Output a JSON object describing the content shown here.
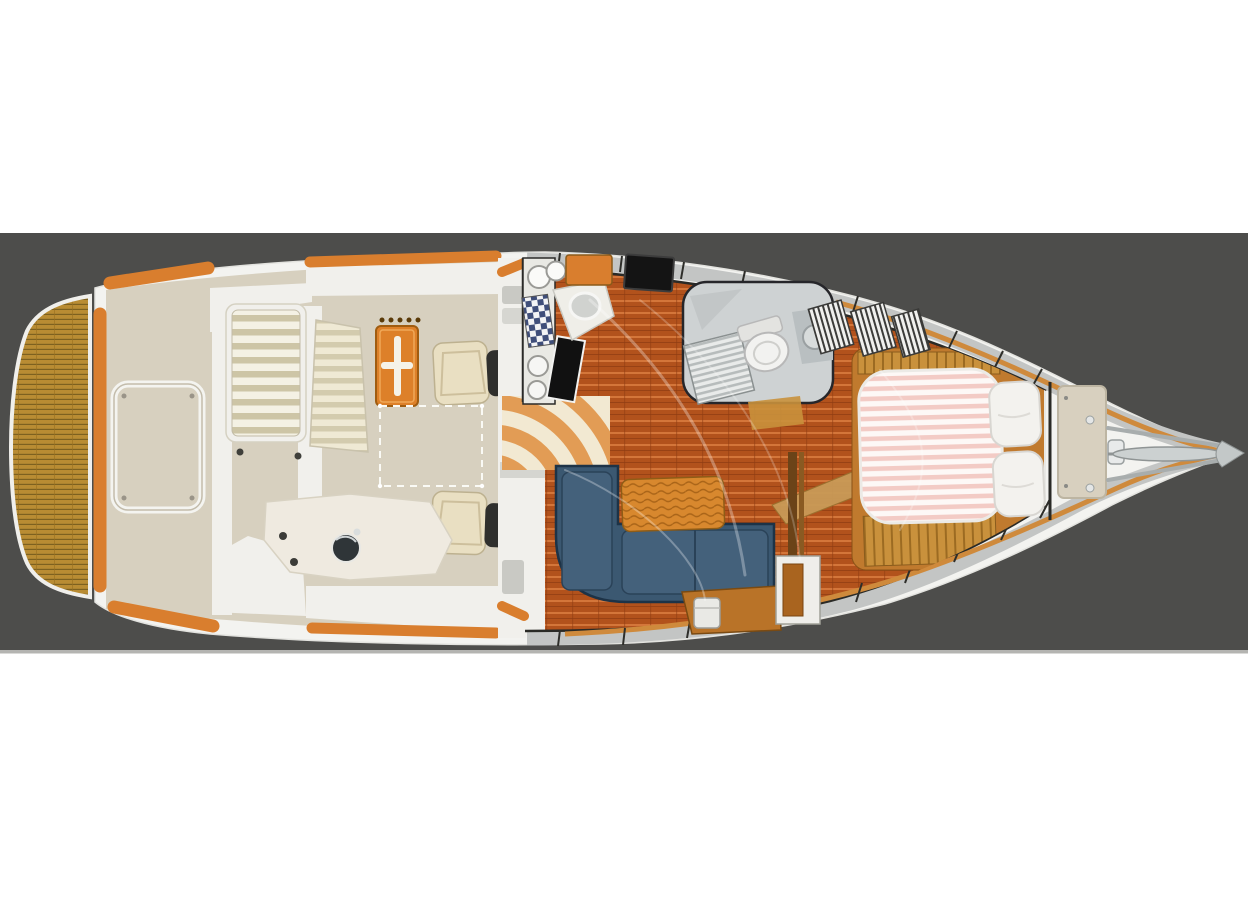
{
  "scene": {
    "type": "boat-deck-floor-plan",
    "description": "Top-down yacht interior floor plan, stern at left with teak swim platform, cockpit with table and helm chairs, salon with L-shaped blue settee, galley, head with shower and toilet, forward island berth with pillows, bow pulpit with anchor at right, drawn on a dark gray horizontal band over a white page",
    "parts": [
      "swim-platform",
      "transom",
      "cockpit-sole",
      "engine-hatch",
      "transom-bench",
      "flybridge-steps",
      "cockpit-table",
      "helm-chair-aft",
      "helm-chair-forward",
      "wet-bar-sink",
      "side-walkway",
      "companionway-stairs",
      "galley-sinks",
      "galley-stove",
      "galley-oven",
      "galley-cabinet",
      "tv-panel",
      "head-compartment",
      "shower-grate",
      "toilet",
      "head-sink",
      "salon-floor",
      "l-settee",
      "bolster-cushion",
      "salon-cabinet",
      "handrail-post",
      "starboard-cabinet",
      "v-berth-mattress",
      "berth-pillows",
      "berth-steps",
      "louvered-lockers",
      "forward-bulkhead",
      "foredeck-hatch",
      "windlass",
      "bow-pulpit",
      "anchor"
    ]
  },
  "colors": {
    "background": "#ffffff",
    "band": "#4d4d4b",
    "bandEdge": "#b4b4b1",
    "hull": "#f3f3f0",
    "outline": "#2a2a26",
    "deck": "#d7d0bf",
    "molding": "#f1f0ec",
    "teak": "#b98c33",
    "teakLine": "#7d6120",
    "caprail": "#d97e2e",
    "windowBand": "#c3c5c4",
    "caplineThin": "#cf8a3c",
    "tableOrange": "#dd8029",
    "tableCross": "#f5f2e8",
    "chairCream": "#e9dfc2",
    "chairBack": "#2f2f2d",
    "floorWood": "#b2521c",
    "floorLineLight": "#d4763a",
    "floorLineDark": "#8e3c12",
    "stairOrange": "#e29c55",
    "stairCream": "#f2e9d2",
    "setteeBlue": "#3b5871",
    "setteeSeat": "#44617b",
    "setteeDark": "#1d3347",
    "bolster": "#d8882e",
    "cabinetWood": "#b97328",
    "mattressPink": "#f3cbc5",
    "mattressWhite": "#fdf8f6",
    "pillow": "#f3f2ee",
    "headGray": "#ced2d3",
    "fixture": "#f2f2f0",
    "oven": "#111111",
    "tv": "#141414",
    "anchorSilver": "#ccd1d1",
    "berthWood": "#c07a2e",
    "berthStep": "#c9913c",
    "grayStep": "#c9c9c4",
    "checkerBlue": "#3f4e7a"
  }
}
